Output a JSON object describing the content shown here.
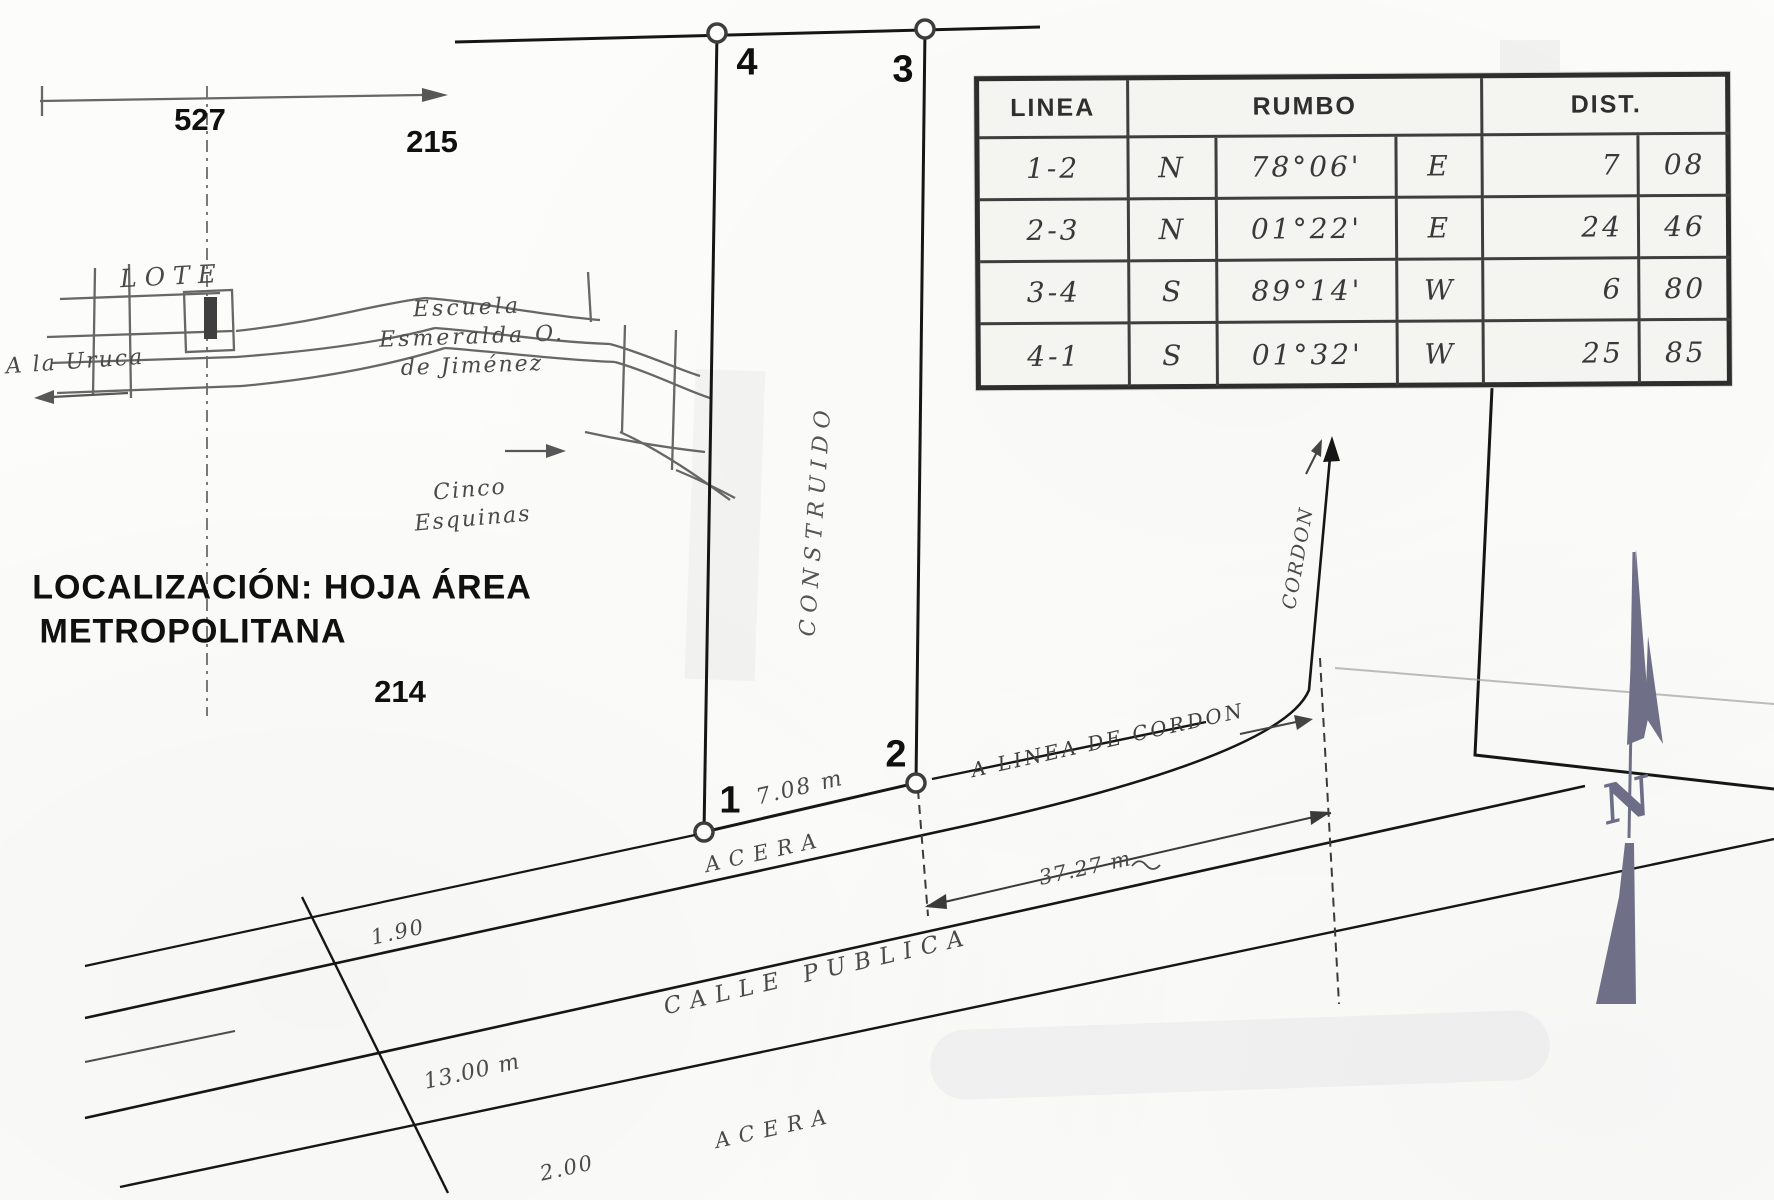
{
  "location_map": {
    "grid_refs": {
      "ref_527": "527",
      "ref_215": "215",
      "ref_214": "214"
    },
    "lote_label": "LOTE",
    "a_la_uruca": "A la Uruca",
    "escuela": {
      "line1": "Escuela",
      "line2": "Esmeralda O.",
      "line3": "de Jiménez"
    },
    "cinco_esquinas": {
      "line1": "Cinco",
      "line2": "Esquinas"
    },
    "caption": {
      "line1": "LOCALIZACIÓN: HOJA ÁREA",
      "line2": "METROPOLITANA"
    }
  },
  "lot": {
    "vertex_1": "1",
    "vertex_2": "2",
    "vertex_3": "3",
    "vertex_4": "4",
    "construido_label": "CONSTRUIDO",
    "frontage_dim": "7.08 m"
  },
  "survey_table": {
    "col_linea": "LINEA",
    "col_rumbo": "RUMBO",
    "col_dist": "DIST.",
    "rows": [
      {
        "linea": "1-2",
        "ns": "N",
        "angle": "78°06'",
        "ew": "E",
        "dist_int": "7",
        "dist_dec": "08"
      },
      {
        "linea": "2-3",
        "ns": "N",
        "angle": "01°22'",
        "ew": "E",
        "dist_int": "24",
        "dist_dec": "46"
      },
      {
        "linea": "3-4",
        "ns": "S",
        "angle": "89°14'",
        "ew": "W",
        "dist_int": "6",
        "dist_dec": "80"
      },
      {
        "linea": "4-1",
        "ns": "S",
        "angle": "01°32'",
        "ew": "W",
        "dist_int": "25",
        "dist_dec": "85"
      }
    ]
  },
  "street": {
    "acera_top": "ACERA",
    "calle_publica": "CALLE PUBLICA",
    "acera_bottom": "ACERA",
    "linea_cordon": "A LINEA DE CORDON",
    "cordon": "CORDON",
    "dim_frontage_offset": "37.27 m",
    "dim_sidewalk_top": "1.90",
    "dim_street_width": "13.00 m",
    "dim_sidewalk_bottom": "2.00"
  },
  "compass": {
    "north_label": "N"
  },
  "colors": {
    "ink": "#161616",
    "hand": "#4a4a4a",
    "arrow_gray": "#6f6f88",
    "paper": "#fcfcfa"
  }
}
